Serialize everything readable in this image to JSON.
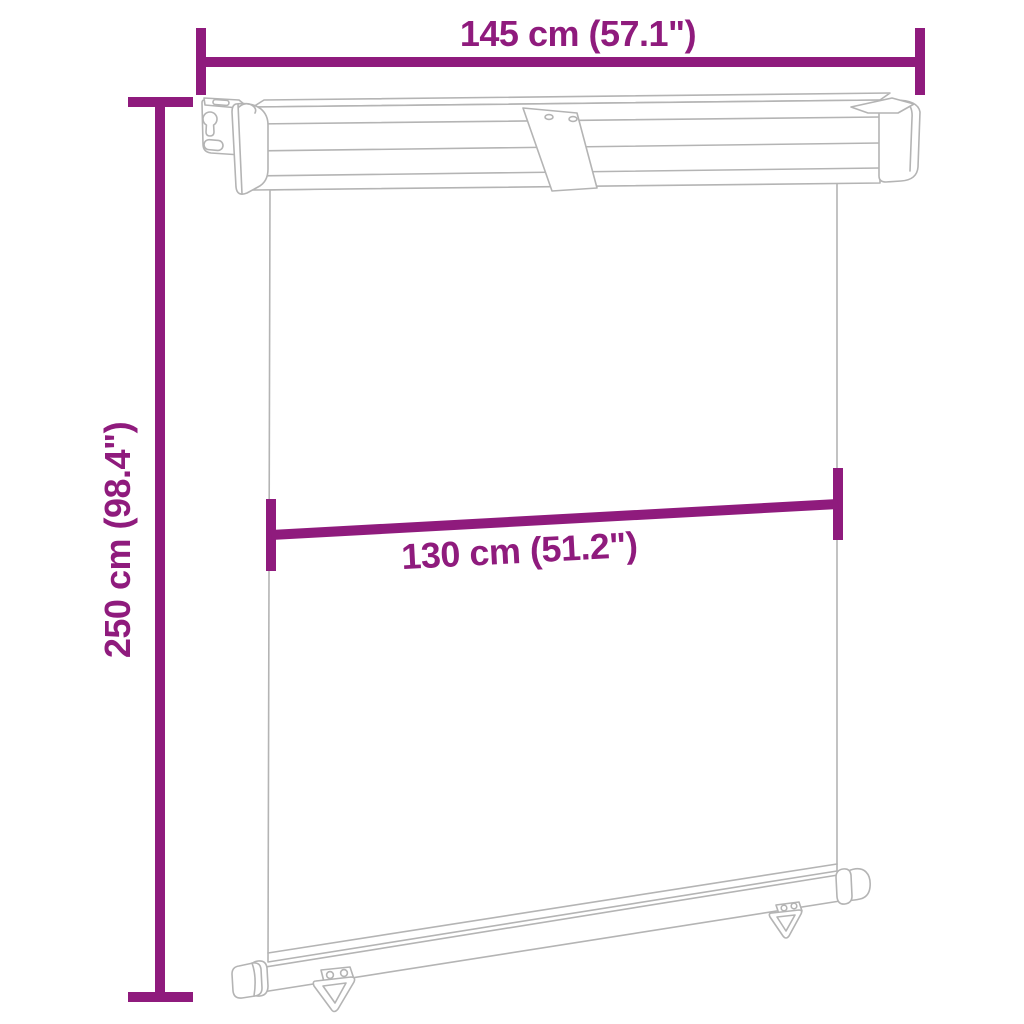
{
  "diagram": {
    "subject": "balcony side awning dimension drawing",
    "labels": {
      "overall_width": "145 cm (57.1\")",
      "overall_height": "250 cm (98.4\")",
      "fabric_width": "130 cm (51.2\")"
    },
    "colors": {
      "dimension_lines": "#8F1B7D",
      "drawing_lines": "#B4B4B4",
      "background": "#FFFFFF"
    }
  }
}
